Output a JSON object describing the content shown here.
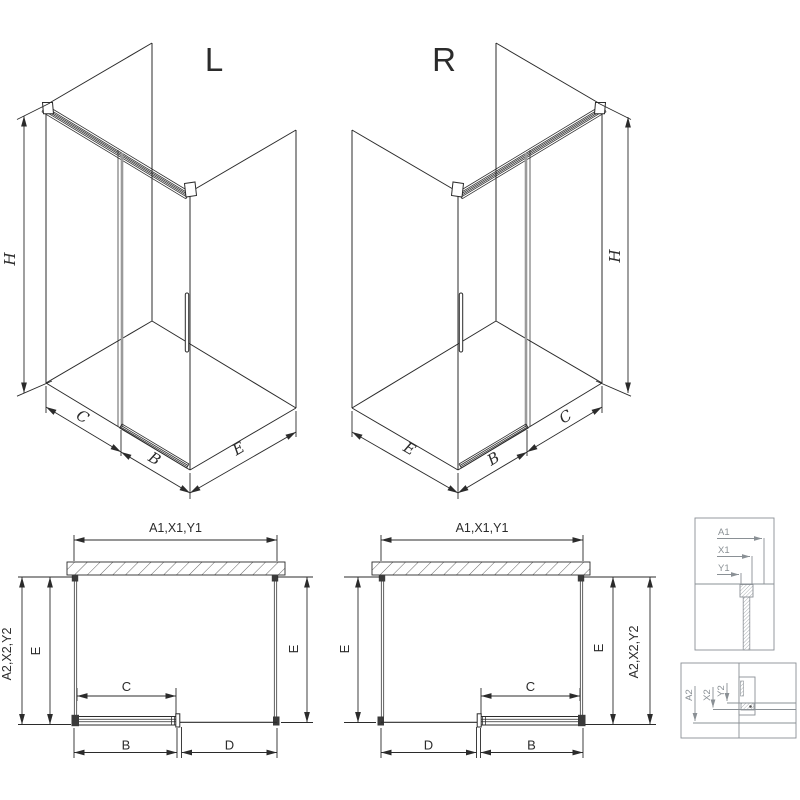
{
  "title_labels": {
    "left_view": "L",
    "right_view": "R"
  },
  "dimension_labels": {
    "height": "H",
    "side_depth": "E",
    "door_width": "B",
    "opening_width": "C",
    "fixed_panel_width": "D"
  },
  "plan_labels": {
    "top_total": "A1,X1,Y1",
    "side_total": "A2,X2,Y2"
  },
  "detail_top": {
    "d1": "A1",
    "d2": "X1",
    "d3": "Y1"
  },
  "detail_bottom": {
    "d1": "A2",
    "d2": "X2",
    "d3": "Y2"
  },
  "colors": {
    "line": "#2b2b2b",
    "glass_edge": "#9a9a9a",
    "detail": "#8a9095",
    "hatch": "#555555"
  }
}
